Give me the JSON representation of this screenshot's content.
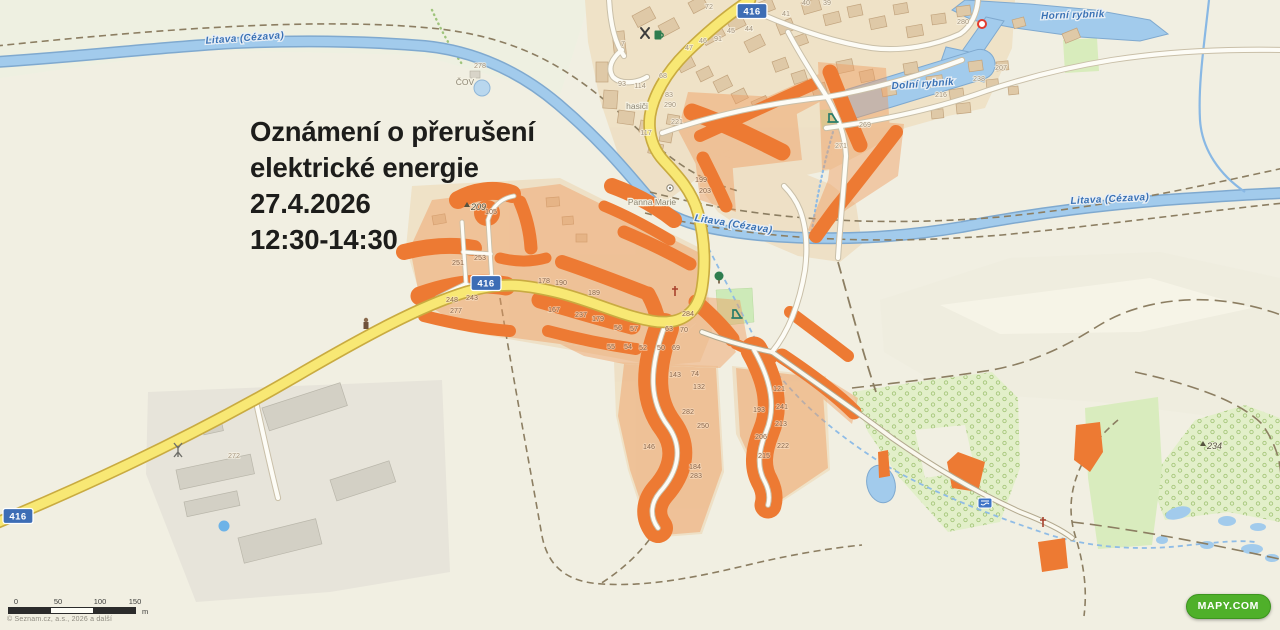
{
  "announcement": {
    "line1": "Oznámení o přerušení",
    "line2": "elektrické energie",
    "date": "27.4.2026",
    "time": "12:30-14:30"
  },
  "map": {
    "place_labels": [
      {
        "text": "Litava (Cézava)",
        "x": 245,
        "y": 41,
        "rot": -4,
        "cls": "water"
      },
      {
        "text": "Litava (Cézava)",
        "x": 733,
        "y": 227,
        "rot": 9,
        "cls": "water"
      },
      {
        "text": "Litava (Cézava)",
        "x": 1110,
        "y": 202,
        "rot": -3,
        "cls": "water"
      },
      {
        "text": "Horní rybník",
        "x": 1073,
        "y": 18,
        "rot": -2,
        "cls": "water"
      },
      {
        "text": "Dolní rybník",
        "x": 923,
        "y": 87,
        "rot": -4,
        "cls": "water"
      },
      {
        "text": "hasiči",
        "x": 637,
        "y": 109,
        "rot": 0,
        "cls": "village"
      },
      {
        "text": "Panna Marie",
        "x": 652,
        "y": 205,
        "rot": 0,
        "cls": "village"
      },
      {
        "text": "ČOV",
        "x": 465,
        "y": 85,
        "rot": 0,
        "cls": "village"
      }
    ],
    "elevations": [
      {
        "t": "209",
        "x": 468,
        "y": 210
      },
      {
        "t": "234",
        "x": 1204,
        "y": 449
      }
    ],
    "road_shields": [
      {
        "t": "416",
        "x": 18,
        "y": 516
      },
      {
        "t": "416",
        "x": 486,
        "y": 283
      },
      {
        "t": "416",
        "x": 752,
        "y": 11
      }
    ],
    "house_numbers": [
      {
        "t": "72",
        "x": 709,
        "y": 9
      },
      {
        "t": "41",
        "x": 786,
        "y": 16
      },
      {
        "t": "40",
        "x": 806,
        "y": 5
      },
      {
        "t": "39",
        "x": 827,
        "y": 5
      },
      {
        "t": "45",
        "x": 731,
        "y": 33
      },
      {
        "t": "44",
        "x": 749,
        "y": 31
      },
      {
        "t": "46",
        "x": 703,
        "y": 43
      },
      {
        "t": "91",
        "x": 718,
        "y": 41
      },
      {
        "t": "47",
        "x": 689,
        "y": 50
      },
      {
        "t": "7",
        "x": 623,
        "y": 46
      },
      {
        "t": "68",
        "x": 663,
        "y": 78
      },
      {
        "t": "93",
        "x": 622,
        "y": 86
      },
      {
        "t": "114",
        "x": 640,
        "y": 88
      },
      {
        "t": "83",
        "x": 669,
        "y": 97
      },
      {
        "t": "290",
        "x": 670,
        "y": 107
      },
      {
        "t": "221",
        "x": 677,
        "y": 124
      },
      {
        "t": "117",
        "x": 646,
        "y": 135
      },
      {
        "t": "280",
        "x": 963,
        "y": 24
      },
      {
        "t": "207",
        "x": 1001,
        "y": 70
      },
      {
        "t": "238",
        "x": 979,
        "y": 81
      },
      {
        "t": "216",
        "x": 941,
        "y": 97
      },
      {
        "t": "269",
        "x": 865,
        "y": 127
      },
      {
        "t": "271",
        "x": 841,
        "y": 148
      },
      {
        "t": "278",
        "x": 480,
        "y": 68
      },
      {
        "t": "199",
        "x": 701,
        "y": 182,
        "d": 1
      },
      {
        "t": "203",
        "x": 705,
        "y": 193,
        "d": 1
      },
      {
        "t": "105",
        "x": 491,
        "y": 214,
        "d": 1
      },
      {
        "t": "253",
        "x": 480,
        "y": 260,
        "d": 1
      },
      {
        "t": "251",
        "x": 458,
        "y": 265,
        "d": 1
      },
      {
        "t": "248",
        "x": 452,
        "y": 302,
        "d": 1
      },
      {
        "t": "243",
        "x": 472,
        "y": 300,
        "d": 1
      },
      {
        "t": "277",
        "x": 456,
        "y": 313,
        "d": 1
      },
      {
        "t": "178",
        "x": 544,
        "y": 283,
        "d": 1
      },
      {
        "t": "190",
        "x": 561,
        "y": 285,
        "d": 1
      },
      {
        "t": "189",
        "x": 594,
        "y": 295,
        "d": 1
      },
      {
        "t": "167",
        "x": 554,
        "y": 312,
        "d": 1
      },
      {
        "t": "237",
        "x": 581,
        "y": 317,
        "d": 1
      },
      {
        "t": "179",
        "x": 598,
        "y": 321,
        "d": 1
      },
      {
        "t": "56",
        "x": 618,
        "y": 330,
        "d": 1
      },
      {
        "t": "57",
        "x": 634,
        "y": 331,
        "d": 1
      },
      {
        "t": "63",
        "x": 669,
        "y": 331,
        "d": 1
      },
      {
        "t": "70",
        "x": 684,
        "y": 332,
        "d": 1
      },
      {
        "t": "55",
        "x": 611,
        "y": 349,
        "d": 1
      },
      {
        "t": "54",
        "x": 628,
        "y": 349,
        "d": 1
      },
      {
        "t": "52",
        "x": 643,
        "y": 350,
        "d": 1
      },
      {
        "t": "50",
        "x": 661,
        "y": 350,
        "d": 1
      },
      {
        "t": "69",
        "x": 676,
        "y": 350,
        "d": 1
      },
      {
        "t": "284",
        "x": 688,
        "y": 316,
        "d": 1
      },
      {
        "t": "143",
        "x": 675,
        "y": 377,
        "d": 1
      },
      {
        "t": "74",
        "x": 695,
        "y": 376,
        "d": 1
      },
      {
        "t": "132",
        "x": 699,
        "y": 389,
        "d": 1
      },
      {
        "t": "282",
        "x": 688,
        "y": 414,
        "d": 1
      },
      {
        "t": "250",
        "x": 703,
        "y": 428,
        "d": 1
      },
      {
        "t": "146",
        "x": 649,
        "y": 449,
        "d": 1
      },
      {
        "t": "184",
        "x": 695,
        "y": 469,
        "d": 1
      },
      {
        "t": "283",
        "x": 696,
        "y": 478,
        "d": 1
      },
      {
        "t": "121",
        "x": 779,
        "y": 391,
        "d": 1
      },
      {
        "t": "193",
        "x": 759,
        "y": 412,
        "d": 1
      },
      {
        "t": "241",
        "x": 782,
        "y": 409,
        "d": 1
      },
      {
        "t": "213",
        "x": 781,
        "y": 426,
        "d": 1
      },
      {
        "t": "206",
        "x": 761,
        "y": 439,
        "d": 1
      },
      {
        "t": "222",
        "x": 783,
        "y": 448,
        "d": 1
      },
      {
        "t": "215",
        "x": 764,
        "y": 458,
        "d": 1
      },
      {
        "t": "272",
        "x": 234,
        "y": 458
      }
    ]
  },
  "scalebar": {
    "ticks": [
      "0",
      "50",
      "100",
      "150"
    ],
    "unit": "m"
  },
  "attribution": {
    "copyright": "© Seznam.cz, a.s., 2026 a další"
  },
  "logo": {
    "text": "MAPY.COM"
  },
  "colors": {
    "outage_orange": "#ed7a33",
    "outage_parcel": "#f09c5f",
    "road_yellow": "#f8e874",
    "water_blue": "#a2cbec",
    "shield_blue": "#3d6db5",
    "logo_green": "#4fb02a"
  }
}
